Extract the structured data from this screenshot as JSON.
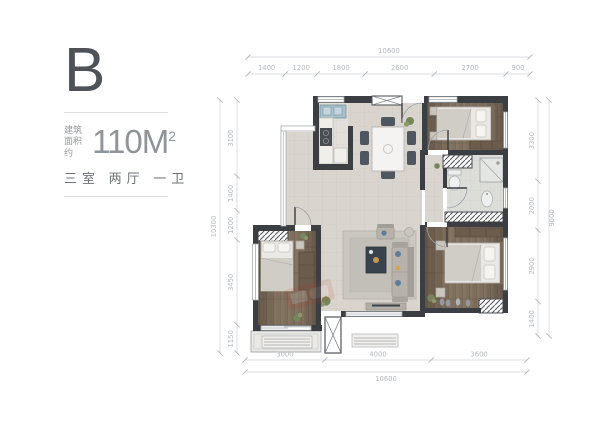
{
  "panel": {
    "plan_letter": "B",
    "area_label_line1": "建筑",
    "area_label_line2": "面积约",
    "area_value": "110M",
    "area_sup": "2",
    "layout_text": "三室 两厅 一卫"
  },
  "dimensions": {
    "top": {
      "total": "10600",
      "segments": [
        "1400",
        "1200",
        "1800",
        "2600",
        "2700",
        "900"
      ]
    },
    "bottom": {
      "total": "10600",
      "segments": [
        "3000",
        "4000",
        "3600"
      ]
    },
    "left": {
      "total": "10300",
      "segments": [
        "3100",
        "1400",
        "1200",
        "3450",
        "1150"
      ]
    },
    "right": {
      "total": "9600",
      "segments": [
        "3300",
        "2000",
        "2900",
        "1400"
      ]
    }
  },
  "colors": {
    "wall": "#3b3e43",
    "dim_text": "#b4b8bc",
    "dim_line": "#cfd2d5",
    "wood": "#80705f",
    "tile": "#d9d5ce",
    "accent_blue": "#5f7c99",
    "plant_green": "#74875a",
    "watermark_red": "#c0392b"
  }
}
